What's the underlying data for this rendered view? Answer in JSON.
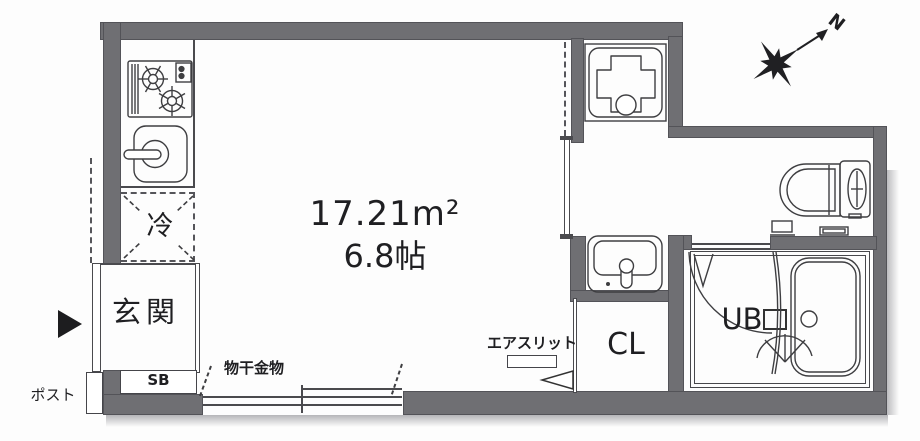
{
  "plan": {
    "type": "japanese-apartment-floor-plan",
    "area_sqm": "17.21m²",
    "area_tatami": "6.8帖",
    "rooms": {
      "entrance": "玄関",
      "refrigerator_space": "冷",
      "closet": "CL",
      "unit_bath": "UB",
      "shoe_box": "SB"
    },
    "annotations": {
      "post": "ポスト",
      "drying_hardware": "物干金物",
      "air_slit": "エアスリット",
      "compass_north": "N"
    },
    "icons": {
      "stove": "gas-stove-icon",
      "kitchen_sink": "kitchen-sink-icon",
      "washing_machine_pan": "washing-machine-pan-icon",
      "toilet": "toilet-icon",
      "washbasin": "washbasin-icon",
      "bathtub": "bathtub-icon",
      "compass": "compass-rose-icon",
      "entrance_marker": "entrance-arrow-icon",
      "window": "sliding-window-symbol",
      "door_arc": "bath-door-swing-arc"
    },
    "colors": {
      "wall": "#6f6f73",
      "line": "#3e3e41",
      "text": "#1f1f22",
      "background": "#ffffff"
    }
  }
}
